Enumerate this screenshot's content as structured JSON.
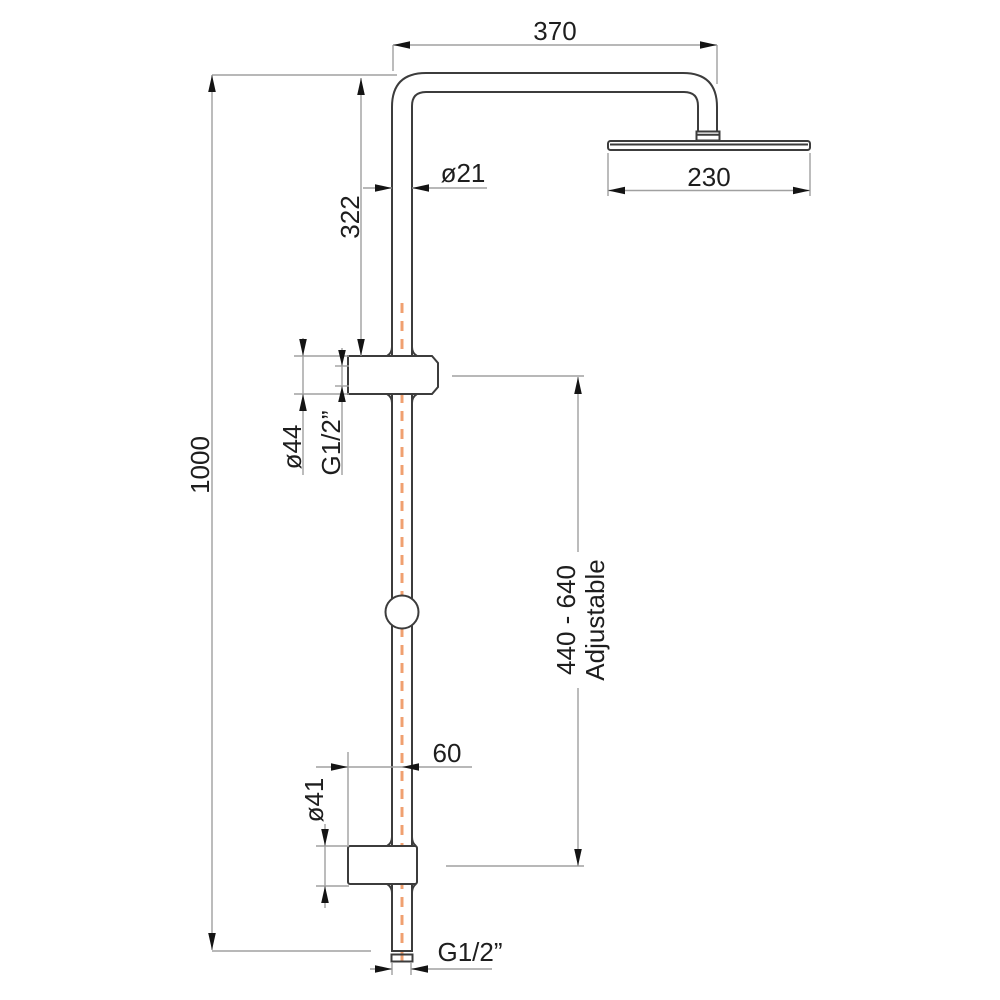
{
  "title": "Shower column technical dimension drawing",
  "colors": {
    "background": "#ffffff",
    "outline": "#3c3c3c",
    "dimension_line": "#a0a0a0",
    "arrow": "#141414",
    "text": "#1e1e1e",
    "centerline": "#f0a070"
  },
  "labels": {
    "dim_370": "370",
    "dim_230": "230",
    "dim_pipe_diameter": "ø21",
    "dim_322": "322",
    "dim_1000": "1000",
    "dim_upper_bracket_diameter": "ø44",
    "dim_upper_thread": "G1/2”",
    "dim_adjustable_range": "440 - 640",
    "dim_adjustable_word": "Adjustable",
    "dim_60": "60",
    "dim_lower_bracket_diameter": "ø41",
    "dim_outlet_thread": "G1/2”"
  }
}
